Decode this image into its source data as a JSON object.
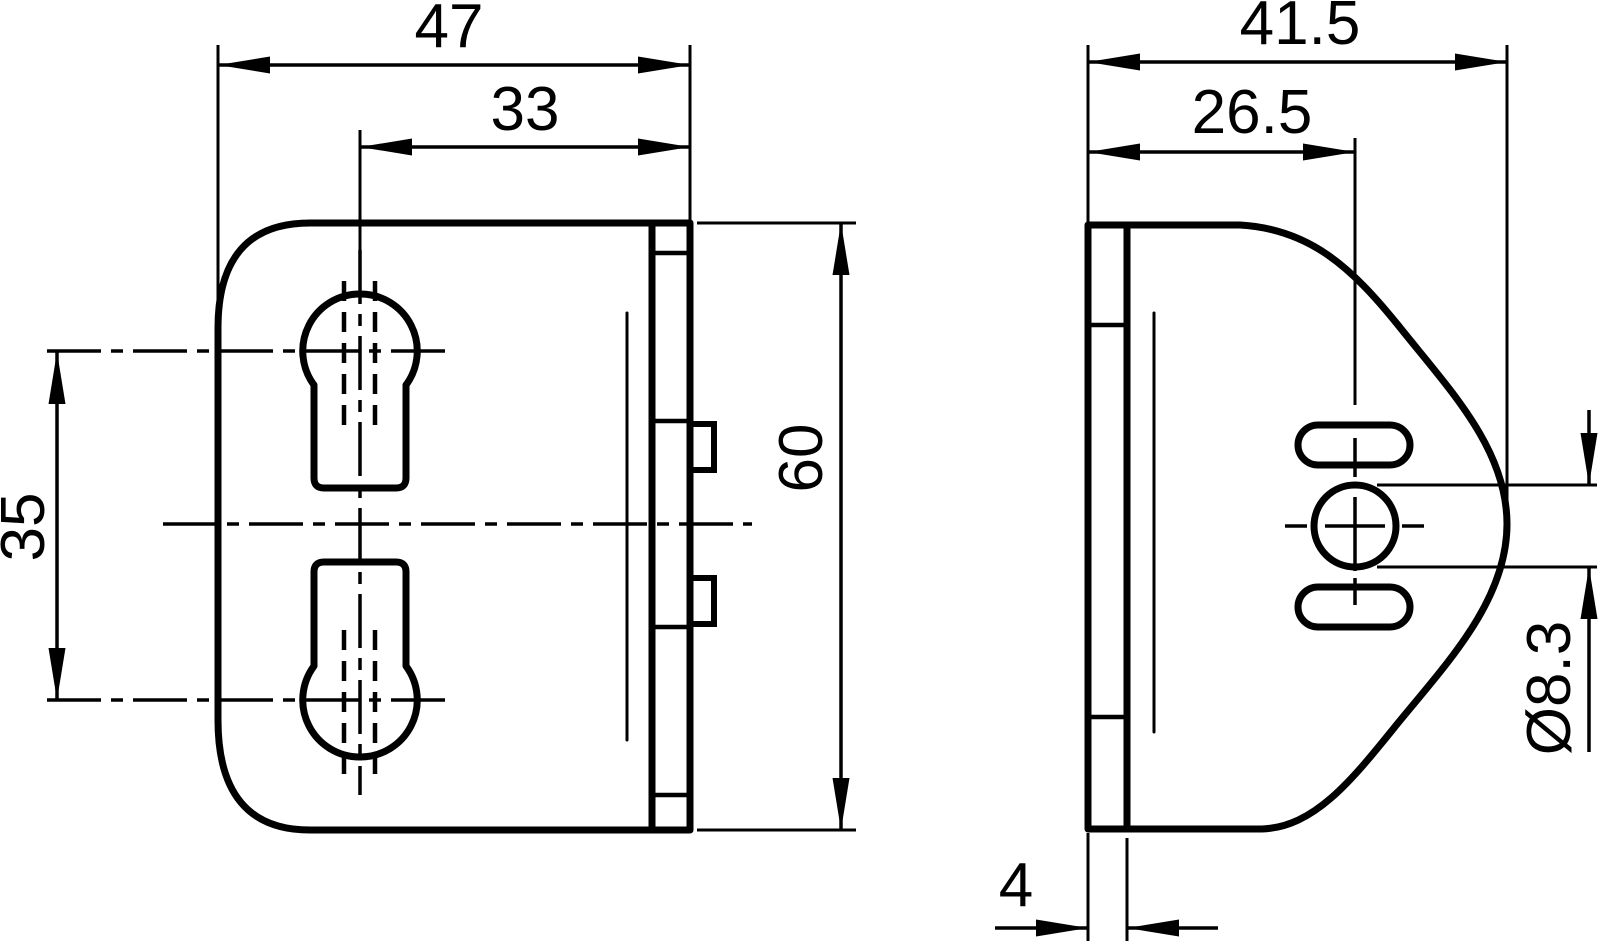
{
  "drawing": {
    "kind": "technical-drawing",
    "colors": {
      "line": "#000000",
      "background": "#ffffff"
    },
    "views": {
      "front": {
        "name": "front view"
      },
      "side": {
        "name": "side view"
      }
    },
    "dimensions": {
      "front_width": {
        "value": "47"
      },
      "slot_offset": {
        "value": "33"
      },
      "slot_spacing": {
        "value": "35"
      },
      "front_height": {
        "value": "60"
      },
      "side_width": {
        "value": "41.5"
      },
      "hole_offset": {
        "value": "26.5"
      },
      "hole_diameter": {
        "value": "Ø8.3"
      },
      "thickness": {
        "value": "4"
      }
    }
  }
}
